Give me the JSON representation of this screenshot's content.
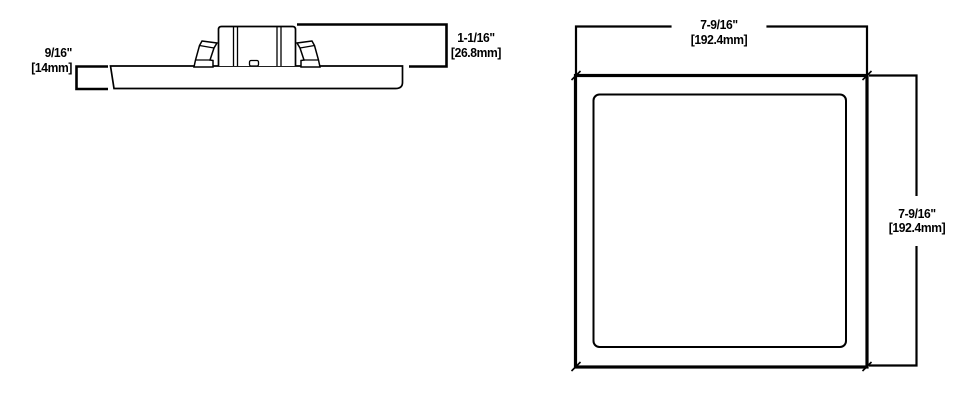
{
  "page": {
    "background": "#ffffff",
    "line_color": "#000000"
  },
  "side_view": {
    "thickness": {
      "inches": "9/16\"",
      "mm": "[14mm]"
    },
    "housing_height": {
      "inches": "1-1/16\"",
      "mm": "[26.8mm]"
    }
  },
  "front_view": {
    "width": {
      "inches": "7-9/16\"",
      "mm": "[192.4mm]"
    },
    "height": {
      "inches": "7-9/16\"",
      "mm": "[192.4mm]"
    }
  }
}
